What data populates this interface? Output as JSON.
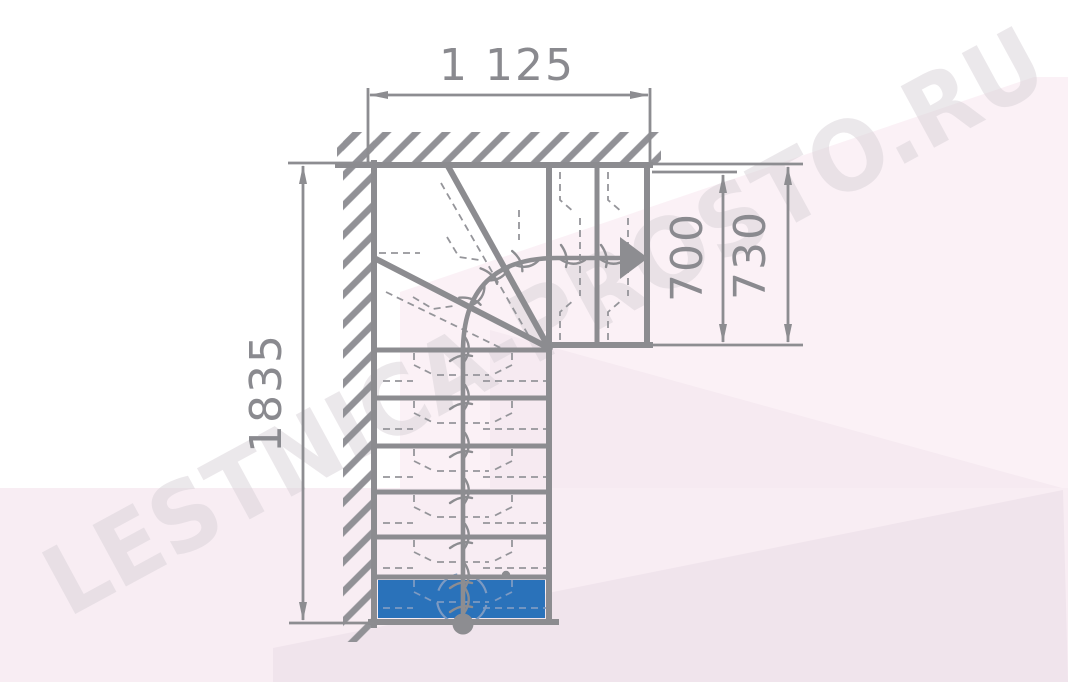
{
  "watermark": {
    "text": "LESTNICA-PROSTO.RU"
  },
  "dimensions": {
    "top_width": "1 125",
    "left_height": "1835",
    "upper_flight_inner": "700",
    "upper_flight_outer": "730"
  },
  "plan": {
    "type": "L-shaped quarter-turn staircase plan, top view",
    "straight_steps": 6,
    "winder_steps": 3,
    "upper_steps": 2,
    "first_step_highlighted": true,
    "walls": [
      "left",
      "top"
    ],
    "ascent": "from bottom start circle, up the straight flight, turning right through winders, exiting right at the arrow"
  },
  "colors": {
    "line_gray": "#8c8c90",
    "dimension_gray": "#8a8a8f",
    "dash_gray": "#95959a",
    "first_step_blue": "#2a72ba",
    "first_step_marking": "#7d9ac2",
    "watermark_text": "#d9d2d8",
    "watermark_pink_light": "#fbf1f6",
    "watermark_pink_mid": "#f6eaf1",
    "watermark_pink_band": "#f8edf3",
    "watermark_pink_deep": "#f0e4ec",
    "background": "#ffffff"
  }
}
